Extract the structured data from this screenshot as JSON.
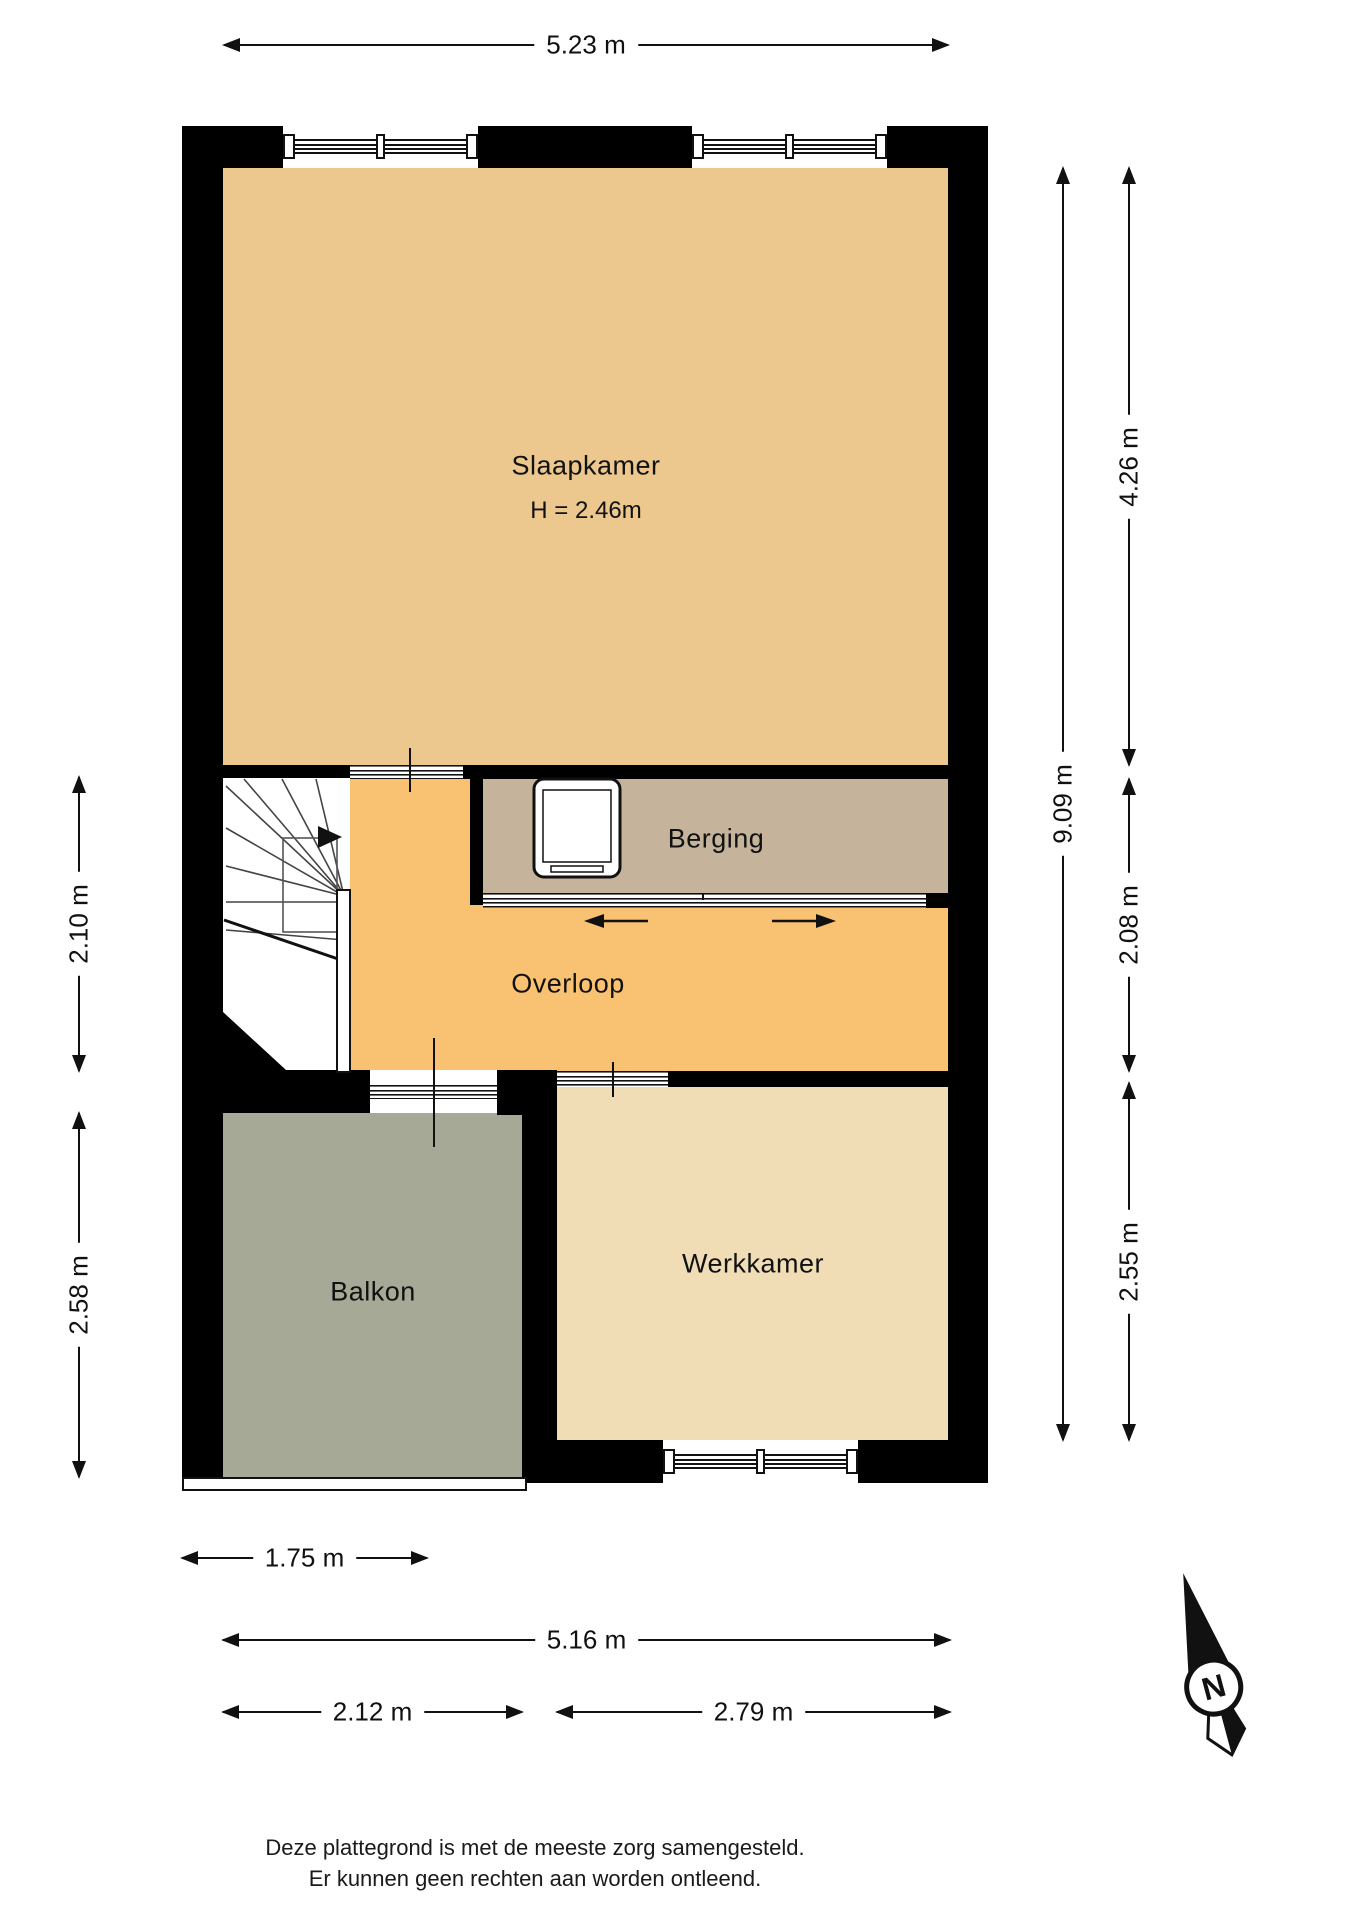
{
  "rooms": {
    "slaapkamer": {
      "label": "Slaapkamer",
      "ceiling_height": "H = 2.46m"
    },
    "berging": {
      "label": "Berging"
    },
    "overloop": {
      "label": "Overloop"
    },
    "balkon": {
      "label": "Balkon"
    },
    "werkkamer": {
      "label": "Werkkamer"
    }
  },
  "dimensions": {
    "top_width": "5.23 m",
    "left_landing_depth": "2.10 m",
    "left_balcony_depth": "2.58 m",
    "right_total_depth": "9.09 m",
    "right_bedroom_depth": "4.26 m",
    "right_landing_depth": "2.08 m",
    "right_study_depth": "2.55 m",
    "bottom_left_width": "1.75 m",
    "bottom_total_width": "5.16 m",
    "bottom_balcony_width": "2.12 m",
    "bottom_study_width": "2.79 m"
  },
  "compass": {
    "north_label": "N"
  },
  "footer": {
    "line1": "Deze plattegrond is met de meeste zorg samengesteld.",
    "line2": "Er kunnen geen rechten aan worden ontleend."
  },
  "colors": {
    "wall": "#000000",
    "slaapkamer_floor": "#ECC88E",
    "overloop_floor": "#F9C172",
    "berging_floor": "#C5B49B",
    "werkkamer_floor": "#F0DDB6",
    "balkon_floor": "#A5A996"
  }
}
